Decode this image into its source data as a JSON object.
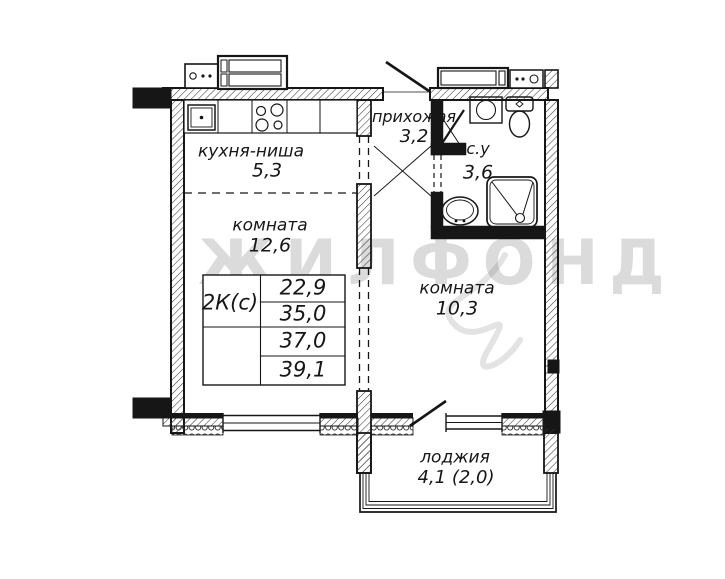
{
  "plan": {
    "title": "apartment-floor-plan",
    "watermark": "ЖИЛФОНД",
    "rooms": [
      {
        "name": "кухня-ниша",
        "area": "5,3"
      },
      {
        "name": "комната",
        "area": "12,6"
      },
      {
        "name": "прихожая",
        "area": "3,2"
      },
      {
        "name": "с.у",
        "area": "3,6"
      },
      {
        "name": "комната",
        "area": "10,3"
      },
      {
        "name": "лоджия",
        "area": "4,1 (2,0)"
      }
    ],
    "info_table": {
      "type_label": "2К(с)",
      "values": [
        "22,9",
        "35,0",
        "37,0",
        "39,1"
      ]
    },
    "colors": {
      "line": "#161616",
      "watermark": "#d9d9d9",
      "background": "#ffffff"
    }
  }
}
